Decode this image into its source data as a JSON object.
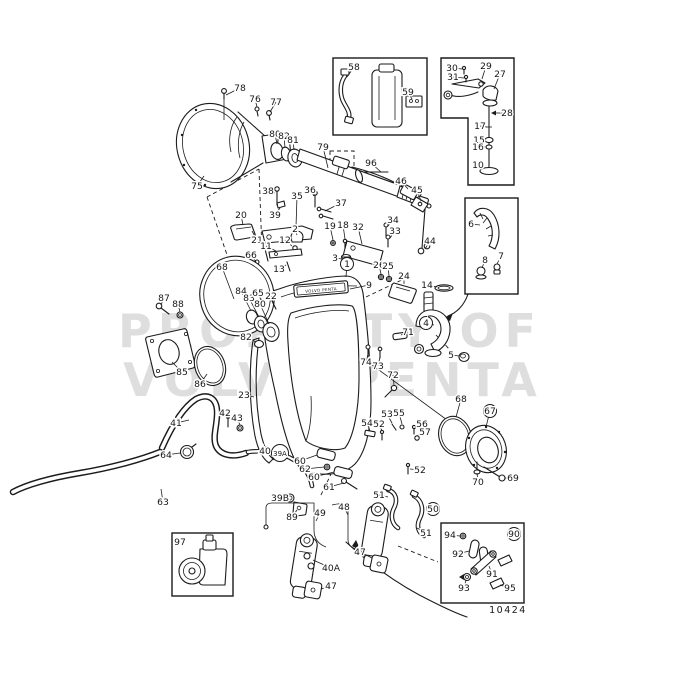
{
  "watermark": {
    "line1": "PROPERTY OF",
    "line2": "VOLVO PENTA"
  },
  "drawing_number": "10424",
  "badge_text": "VOLVO PENTA",
  "ink_color": "#1b1b1b",
  "watermark_color": "#8a8a8a",
  "labels": [
    {
      "t": "78",
      "x": 240,
      "y": 88,
      "lx": 226,
      "ly": 95
    },
    {
      "t": "76",
      "x": 255,
      "y": 99,
      "lx": 257,
      "ly": 107
    },
    {
      "t": "77",
      "x": 276,
      "y": 102,
      "lx": 270,
      "ly": 112
    },
    {
      "t": "75",
      "x": 197,
      "y": 186,
      "lx": 204,
      "ly": 176
    },
    {
      "t": "80",
      "x": 275,
      "y": 134,
      "lx": 277,
      "ly": 144
    },
    {
      "t": "82",
      "x": 284,
      "y": 136,
      "lx": 285,
      "ly": 148
    },
    {
      "t": "81",
      "x": 293,
      "y": 140,
      "lx": 294,
      "ly": 150
    },
    {
      "t": "79",
      "x": 323,
      "y": 147,
      "lx": 328,
      "ly": 168
    },
    {
      "t": "96",
      "x": 371,
      "y": 163,
      "lx": 381,
      "ly": 172
    },
    {
      "t": "46",
      "x": 401,
      "y": 181,
      "lx": 408,
      "ly": 189
    },
    {
      "t": "45",
      "x": 417,
      "y": 190,
      "lx": 421,
      "ly": 201
    },
    {
      "t": "58",
      "x": 354,
      "y": 67,
      "lx": 347,
      "ly": 77
    },
    {
      "t": "59",
      "x": 408,
      "y": 92,
      "lx": 412,
      "ly": 99
    },
    {
      "t": "30",
      "x": 452,
      "y": 68,
      "lx": 462,
      "ly": 69
    },
    {
      "t": "31",
      "x": 453,
      "y": 77,
      "lx": 464,
      "ly": 78
    },
    {
      "t": "29",
      "x": 486,
      "y": 66,
      "lx": 482,
      "ly": 79
    },
    {
      "t": "27",
      "x": 500,
      "y": 74,
      "lx": 494,
      "ly": 89
    },
    {
      "t": "28",
      "x": 507,
      "y": 113,
      "lx": 493,
      "ly": 113
    },
    {
      "t": "17",
      "x": 480,
      "y": 126,
      "lx": 487,
      "ly": 127
    },
    {
      "t": "15",
      "x": 479,
      "y": 140,
      "lx": 485,
      "ly": 140
    },
    {
      "t": "16",
      "x": 478,
      "y": 147,
      "lx": 485,
      "ly": 147
    },
    {
      "t": "10",
      "x": 478,
      "y": 165,
      "lx": 484,
      "ly": 168
    },
    {
      "t": "6",
      "x": 471,
      "y": 224,
      "lx": 480,
      "ly": 225
    },
    {
      "t": "8",
      "x": 485,
      "y": 260,
      "lx": 482,
      "ly": 268
    },
    {
      "t": "7",
      "x": 501,
      "y": 256,
      "lx": 497,
      "ly": 264
    },
    {
      "t": "38",
      "x": 268,
      "y": 191,
      "lx": 275,
      "ly": 193
    },
    {
      "t": "35",
      "x": 297,
      "y": 196,
      "lx": 296,
      "ly": 227
    },
    {
      "t": "36",
      "x": 310,
      "y": 190,
      "lx": 314,
      "ly": 196
    },
    {
      "t": "37",
      "x": 341,
      "y": 203,
      "lx": 325,
      "ly": 211
    },
    {
      "t": "39",
      "x": 275,
      "y": 215,
      "lx": 280,
      "ly": 208
    },
    {
      "t": "20",
      "x": 241,
      "y": 215,
      "lx": 243,
      "ly": 225
    },
    {
      "t": "21",
      "x": 257,
      "y": 240,
      "lx": 252,
      "ly": 231
    },
    {
      "t": "2",
      "x": 295,
      "y": 229,
      "lx": 297,
      "ly": 235
    },
    {
      "t": "12",
      "x": 285,
      "y": 240,
      "lx": 292,
      "ly": 246
    },
    {
      "t": "11",
      "x": 266,
      "y": 246,
      "lx": 276,
      "ly": 251
    },
    {
      "t": "13",
      "x": 279,
      "y": 269,
      "lx": 286,
      "ly": 265
    },
    {
      "t": "66",
      "x": 251,
      "y": 255,
      "lx": 256,
      "ly": 262
    },
    {
      "t": "19",
      "x": 330,
      "y": 226,
      "lx": 333,
      "ly": 240
    },
    {
      "t": "18",
      "x": 343,
      "y": 225,
      "lx": 345,
      "ly": 239
    },
    {
      "t": "32",
      "x": 358,
      "y": 227,
      "lx": 362,
      "ly": 244
    },
    {
      "t": "34",
      "x": 393,
      "y": 220,
      "lx": 388,
      "ly": 226
    },
    {
      "t": "33",
      "x": 395,
      "y": 231,
      "lx": 390,
      "ly": 238
    },
    {
      "t": "44",
      "x": 430,
      "y": 241,
      "lx": 425,
      "ly": 249
    },
    {
      "t": "3",
      "x": 335,
      "y": 258,
      "lx": 342,
      "ly": 259
    },
    {
      "t": "1",
      "x": 347,
      "y": 264,
      "lx": 346,
      "ly": 277,
      "c": 1
    },
    {
      "t": "26",
      "x": 379,
      "y": 265,
      "lx": 381,
      "ly": 274
    },
    {
      "t": "25",
      "x": 388,
      "y": 266,
      "lx": 389,
      "ly": 276
    },
    {
      "t": "24",
      "x": 404,
      "y": 276,
      "lx": 404,
      "ly": 284
    },
    {
      "t": "9",
      "x": 369,
      "y": 285,
      "lx": 350,
      "ly": 289
    },
    {
      "t": "14",
      "x": 427,
      "y": 285,
      "lx": 437,
      "ly": 287
    },
    {
      "t": "4",
      "x": 426,
      "y": 323,
      "lx": 434,
      "ly": 325,
      "c": 1
    },
    {
      "t": "71",
      "x": 408,
      "y": 332,
      "lx": 401,
      "ly": 335
    },
    {
      "t": "5",
      "x": 451,
      "y": 355,
      "lx": 459,
      "ly": 356
    },
    {
      "t": "74",
      "x": 366,
      "y": 362,
      "lx": 368,
      "ly": 354
    },
    {
      "t": "73",
      "x": 378,
      "y": 366,
      "lx": 380,
      "ly": 357
    },
    {
      "t": "72",
      "x": 393,
      "y": 375,
      "lx": 394,
      "ly": 385
    },
    {
      "t": "68",
      "x": 222,
      "y": 267,
      "lx": 234,
      "ly": 299
    },
    {
      "t": "84",
      "x": 241,
      "y": 291,
      "lx": 251,
      "ly": 311
    },
    {
      "t": "83",
      "x": 249,
      "y": 298,
      "lx": 259,
      "ly": 317
    },
    {
      "t": "80",
      "x": 260,
      "y": 304,
      "lx": 269,
      "ly": 324
    },
    {
      "t": "65",
      "x": 258,
      "y": 293,
      "lx": 261,
      "ly": 300
    },
    {
      "t": "22",
      "x": 271,
      "y": 296,
      "lx": 273,
      "ly": 302
    },
    {
      "t": "82",
      "x": 246,
      "y": 337,
      "lx": 256,
      "ly": 342
    },
    {
      "t": "87",
      "x": 164,
      "y": 298,
      "lx": 161,
      "ly": 305
    },
    {
      "t": "88",
      "x": 178,
      "y": 304,
      "lx": 180,
      "ly": 312
    },
    {
      "t": "85",
      "x": 182,
      "y": 372,
      "lx": 172,
      "ly": 362
    },
    {
      "t": "86",
      "x": 200,
      "y": 384,
      "lx": 207,
      "ly": 374
    },
    {
      "t": "23",
      "x": 244,
      "y": 395,
      "lx": 254,
      "ly": 397
    },
    {
      "t": "41",
      "x": 176,
      "y": 423,
      "lx": 189,
      "ly": 420
    },
    {
      "t": "42",
      "x": 225,
      "y": 413,
      "lx": 228,
      "ly": 419
    },
    {
      "t": "43",
      "x": 237,
      "y": 418,
      "lx": 240,
      "ly": 425
    },
    {
      "t": "64",
      "x": 166,
      "y": 455,
      "lx": 180,
      "ly": 453
    },
    {
      "t": "63",
      "x": 163,
      "y": 502,
      "lx": 161,
      "ly": 489
    },
    {
      "t": "40",
      "x": 265,
      "y": 451,
      "lx": 274,
      "ly": 460
    },
    {
      "t": "39A",
      "x": 280,
      "y": 453,
      "c": 1
    },
    {
      "t": "60",
      "x": 300,
      "y": 461,
      "lx": 317,
      "ly": 455
    },
    {
      "t": "62",
      "x": 305,
      "y": 469,
      "lx": 324,
      "ly": 467
    },
    {
      "t": "60",
      "x": 314,
      "y": 477,
      "lx": 334,
      "ly": 472
    },
    {
      "t": "61",
      "x": 329,
      "y": 487,
      "lx": 344,
      "ly": 483
    },
    {
      "t": "39B",
      "x": 280,
      "y": 498,
      "lx": 287,
      "ly": 498
    },
    {
      "t": "89",
      "x": 292,
      "y": 517,
      "lx": 297,
      "ly": 510
    },
    {
      "t": "49",
      "x": 320,
      "y": 513,
      "lx": 316,
      "ly": 521
    },
    {
      "t": "48",
      "x": 344,
      "y": 507,
      "lx": 348,
      "ly": 515
    },
    {
      "t": "40A",
      "x": 331,
      "y": 568,
      "lx": 313,
      "ly": 560
    },
    {
      "t": "47",
      "x": 360,
      "y": 552,
      "lx": 372,
      "ly": 558
    },
    {
      "t": "47",
      "x": 331,
      "y": 586,
      "lx": 321,
      "ly": 589
    },
    {
      "t": "51",
      "x": 379,
      "y": 495,
      "lx": 388,
      "ly": 497
    },
    {
      "t": "51",
      "x": 426,
      "y": 533,
      "lx": 417,
      "ly": 528
    },
    {
      "t": "52",
      "x": 379,
      "y": 424,
      "lx": 382,
      "ly": 431
    },
    {
      "t": "54",
      "x": 367,
      "y": 423,
      "lx": 370,
      "ly": 431
    },
    {
      "t": "53",
      "x": 387,
      "y": 414,
      "lx": 392,
      "ly": 423
    },
    {
      "t": "55",
      "x": 399,
      "y": 413,
      "lx": 402,
      "ly": 424
    },
    {
      "t": "56",
      "x": 422,
      "y": 424,
      "lx": 415,
      "ly": 428
    },
    {
      "t": "57",
      "x": 425,
      "y": 432,
      "lx": 417,
      "ly": 436
    },
    {
      "t": "52",
      "x": 420,
      "y": 470,
      "lx": 410,
      "ly": 469
    },
    {
      "t": "50",
      "x": 433,
      "y": 509,
      "c": 1
    },
    {
      "t": "68",
      "x": 461,
      "y": 399,
      "lx": 456,
      "ly": 417
    },
    {
      "t": "67",
      "x": 490,
      "y": 411,
      "lx": 486,
      "ly": 427,
      "c": 1
    },
    {
      "t": "70",
      "x": 478,
      "y": 482,
      "lx": 477,
      "ly": 473
    },
    {
      "t": "69",
      "x": 513,
      "y": 478,
      "lx": 505,
      "ly": 478
    },
    {
      "t": "97",
      "x": 180,
      "y": 542
    },
    {
      "t": "94",
      "x": 450,
      "y": 535,
      "lx": 460,
      "ly": 536
    },
    {
      "t": "92",
      "x": 458,
      "y": 554,
      "lx": 469,
      "ly": 551
    },
    {
      "t": "90",
      "x": 514,
      "y": 534,
      "c": 1
    },
    {
      "t": "91",
      "x": 492,
      "y": 574,
      "lx": 489,
      "ly": 566
    },
    {
      "t": "93",
      "x": 464,
      "y": 588,
      "lx": 466,
      "ly": 580
    },
    {
      "t": "95",
      "x": 510,
      "y": 588,
      "lx": 500,
      "ly": 585
    }
  ]
}
